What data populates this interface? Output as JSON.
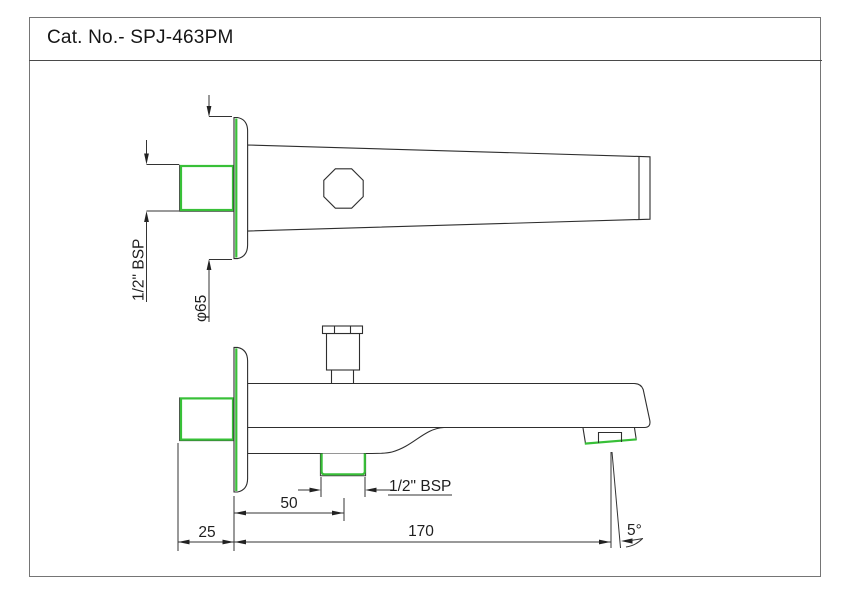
{
  "title": "Cat. No.- SPJ-463PM",
  "drawing": {
    "type": "technical-2-view-catalog-drawing",
    "part": "wall-mounted bath spout with diverter",
    "colors": {
      "highlight_green": "#38c038",
      "line": "#2e2e2e",
      "frame_border": "#757575"
    },
    "labels": {
      "inlet_thread": "1/2\" BSP",
      "flange_diameter": "φ65",
      "outlet_thread": "1/2\" BSP",
      "outlet_center_distance": "50",
      "wall_nipple_length": "25",
      "spout_length": "170",
      "tip_angle": "5°"
    }
  }
}
